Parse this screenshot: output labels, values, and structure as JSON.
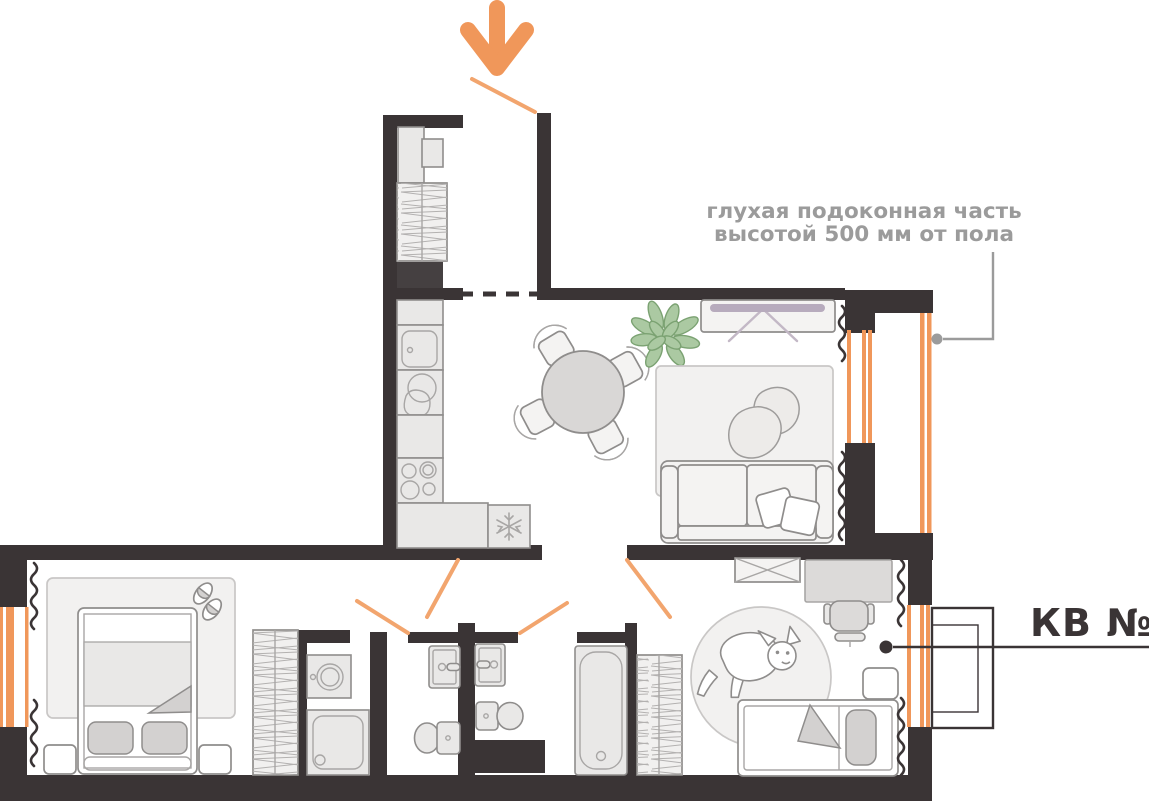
{
  "labels": {
    "apartment": "КВ №1",
    "annotation_line1": "глухая подоконная часть",
    "annotation_line2": "высотой 500 мм от пола"
  },
  "icons": {
    "entrance_arrow": "down-arrow-icon",
    "fridge_badge": "snowflake-icon"
  },
  "colors": {
    "wall": "#3a3435",
    "accent": "#f0975a",
    "accent_light": "#f2a56e",
    "leader": "#9b9b9b",
    "furniture_stroke": "#8f8d8c",
    "furniture_fill": "#f4f3f2",
    "appliance_fill": "#e9e8e7",
    "cushion_fill": "#d3d1d0",
    "rug_stroke": "#c9c7c6",
    "hatch_line": "#b3b1b0",
    "plant_fill": "#abc9a2",
    "plant_stroke": "#7ba272",
    "tv_screen": "#b7abbd",
    "tv_leg": "#c3b8c6"
  }
}
